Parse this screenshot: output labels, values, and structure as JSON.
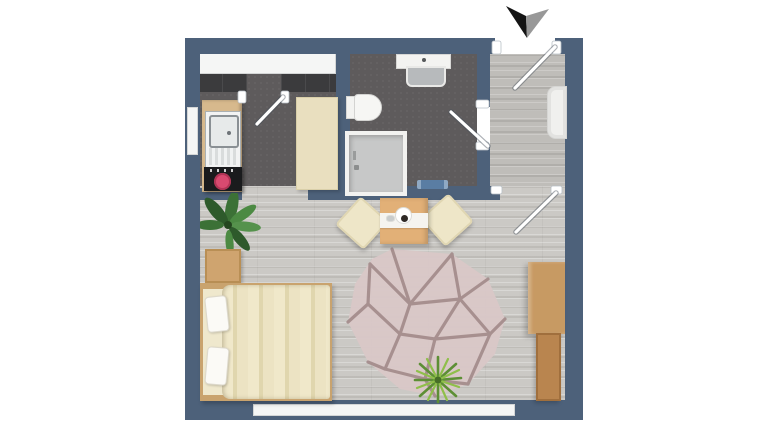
{
  "title": "Studio apartment floor plan (top-down 3D render)",
  "compass": {
    "symbol": "north-arrow",
    "left_wing_color": "#141414",
    "right_wing_color": "#989898"
  },
  "palette": {
    "background": "#ffffff",
    "wall": "#4d617a",
    "window": "#f5f6f5",
    "wet_room_floor": "#5e5b5c",
    "living_floor": "#cbc9c5",
    "hall_floor": "#bfbdb9",
    "counter_wood": "#d7b98d",
    "cabinet_cream": "#e9dfbf",
    "cooktop_black": "#1a1b1d",
    "burner_red": "#d84a70",
    "fixture_white": "#f3f3f1",
    "shower_tray_gray": "#c7c8c8",
    "bath_mat_blue": "#5a7da3",
    "table_wood": "#e2b077",
    "chair_cream": "#eee6c8",
    "bed_duvet_cream": "#ece3c3",
    "bed_frame_wood": "#c9a36e",
    "desk_wood": "#c79a63",
    "rug_base_pink": "#d9c7c7",
    "rug_pattern_taupe": "#a28a8a",
    "plant_green": "#4c8a43"
  },
  "rooms": [
    {
      "id": "kitchen",
      "floor": "dark-tile",
      "features": [
        "window-top",
        "window-left-wall",
        "balcony-style-door",
        "open-passage-to-living-room"
      ]
    },
    {
      "id": "bathroom",
      "floor": "dark-tile",
      "features": [
        "door-from-hall"
      ]
    },
    {
      "id": "entry-hall",
      "floor": "wood-plank",
      "features": [
        "entry-door-top",
        "door-to-living-room"
      ]
    },
    {
      "id": "living-room",
      "floor": "wood-plank",
      "features": [
        "window-bottom-wall"
      ]
    }
  ],
  "furniture": {
    "kitchen": [
      "wood-counter",
      "sink-with-drainer",
      "cooktop-with-red-burner",
      "tall-cream-cabinet"
    ],
    "bathroom": [
      "washbasin-counter",
      "toilet",
      "shower-enclosure",
      "blue-bath-mat"
    ],
    "entry_hall": [
      "radiator"
    ],
    "living_room": [
      "palm-plant",
      "nightstand",
      "double-bed-with-two-pillows",
      "square-dining-table-with-runner-and-tableware",
      "cream-chair-left",
      "cream-chair-right",
      "geometric-patterned-rug",
      "green-floor-plant",
      "wall-desk",
      "sideboard"
    ]
  }
}
